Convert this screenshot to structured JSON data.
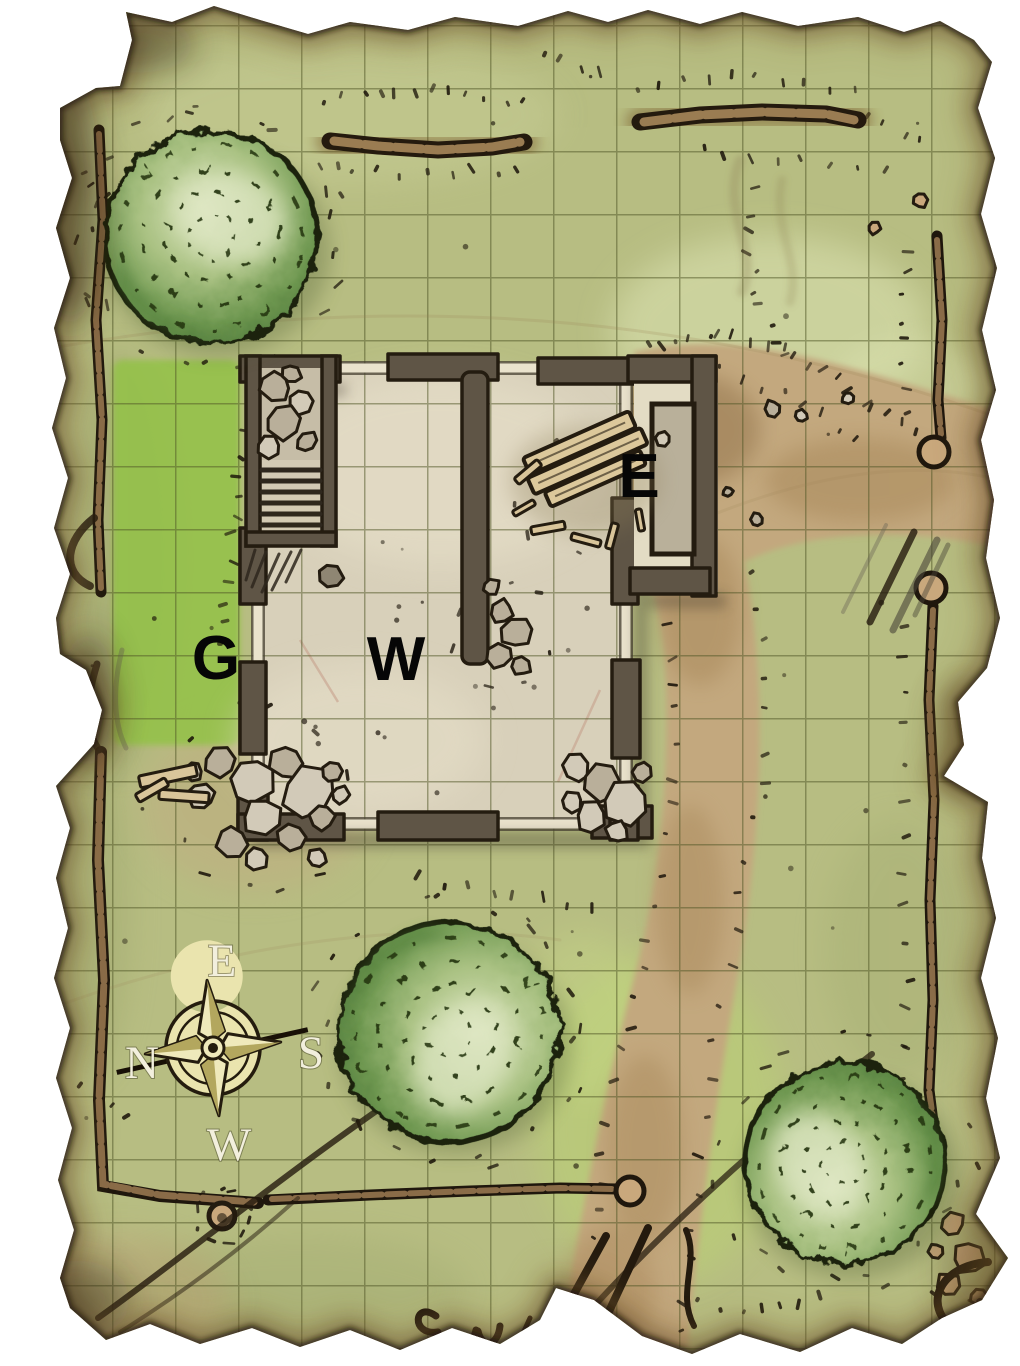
{
  "map": {
    "description": "Hand-drawn tabletop battle map of a ruined stone building on torn parchment",
    "grid": {
      "visible": true,
      "cell_px": 63
    },
    "location_labels": [
      {
        "id": "gap-in-west-wall",
        "text": "G"
      },
      {
        "id": "west-interior",
        "text": "W"
      },
      {
        "id": "east-entry",
        "text": "E"
      }
    ],
    "compass": {
      "top": "E",
      "right": "S",
      "bottom": "W",
      "left": "N"
    },
    "features": [
      "ruined building with collapsed walls",
      "staircase room with rubble",
      "east entry annex",
      "wood plank debris",
      "rubble piles",
      "three trees",
      "dirt path",
      "low stone walls",
      "wooden fences",
      "well",
      "compass rose",
      "ink scribbles on parchment"
    ],
    "palette": {
      "page": "#ffffff",
      "grass": "#b7bd82",
      "grass_bright": "#93c247",
      "grid_line": "#4f5626",
      "dirt": "#c3a87e",
      "floor": "#d8d0ba",
      "wall": "#5f5546",
      "wall_outline": "#241c10",
      "footprint": "#eae3cd",
      "stone": "#cdc5b2",
      "wood": "#dcc89b",
      "ink": "#241a0e",
      "compass_gold": "#eae4ae",
      "compass_letters": "#f2efdd",
      "label_ink": "#060606"
    }
  }
}
